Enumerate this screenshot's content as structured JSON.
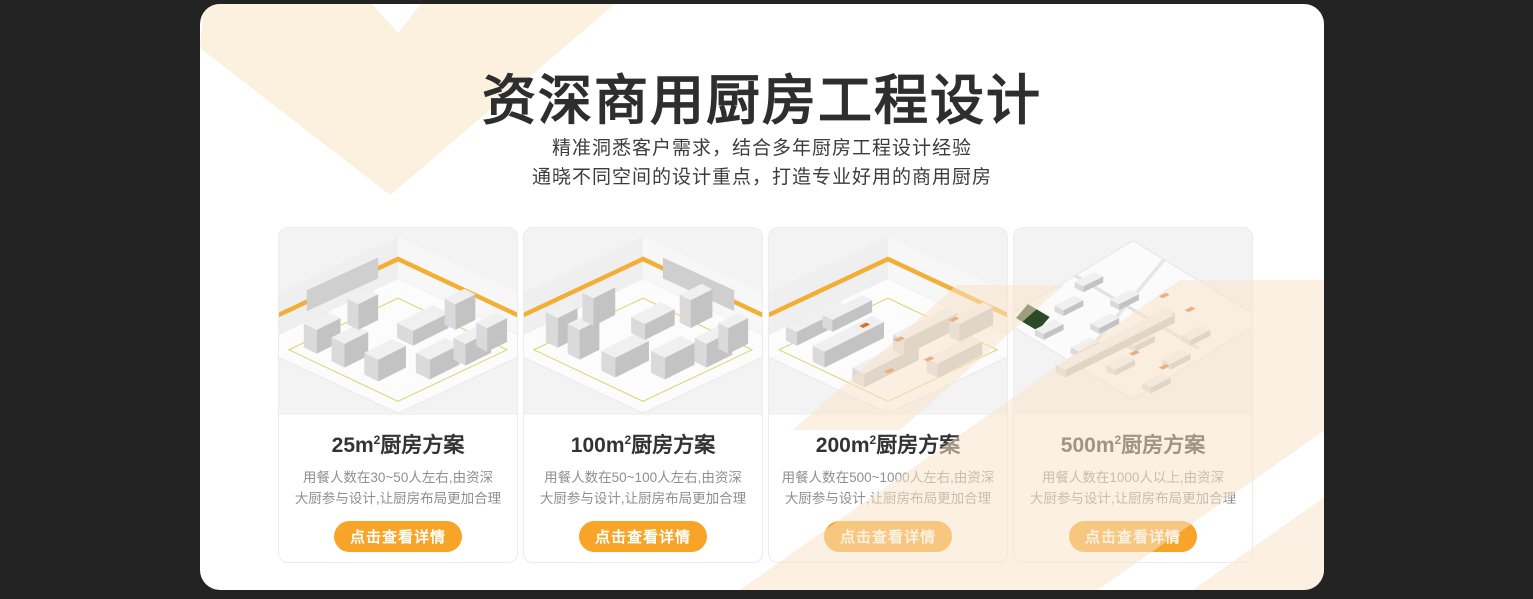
{
  "colors": {
    "page_background": "#232323",
    "panel_background": "#ffffff",
    "accent_orange": "#f7a428",
    "decor_cream": "#fcf0df",
    "title_text": "#2e2e2e",
    "description_text": "#8f8f8f",
    "caution_stripe_yellow": "#f2ae35"
  },
  "header": {
    "title": "资深商用厨房工程设计",
    "subtitle_line1": "精准洞悉客户需求，结合多年厨房工程设计经验",
    "subtitle_line2": "通晓不同空间的设计重点，打造专业好用的商用厨房"
  },
  "cards": [
    {
      "area": "25m",
      "sup": "2",
      "suffix": "厨房方案",
      "image": "kitchen-isometric-render-25sqm",
      "desc_line1": "用餐人数在30~50人左右,由资深",
      "desc_line2": "大厨参与设计,让厨房布局更加合理",
      "button_label": "点击查看详情"
    },
    {
      "area": "100m",
      "sup": "2",
      "suffix": "厨房方案",
      "image": "kitchen-isometric-render-100sqm",
      "desc_line1": "用餐人数在50~100人左右,由资深",
      "desc_line2": "大厨参与设计,让厨房布局更加合理",
      "button_label": "点击查看详情"
    },
    {
      "area": "200m",
      "sup": "2",
      "suffix": "厨房方案",
      "image": "kitchen-isometric-render-200sqm",
      "desc_line1": "用餐人数在500~1000人左右,由资深",
      "desc_line2": "大厨参与设计,让厨房布局更加合理",
      "button_label": "点击查看详情"
    },
    {
      "area": "500m",
      "sup": "2",
      "suffix": "厨房方案",
      "image": "kitchen-isometric-render-500sqm",
      "desc_line1": "用餐人数在1000人以上,由资深",
      "desc_line2": "大厨参与设计,让厨房布局更加合理",
      "button_label": "点击查看详情"
    }
  ]
}
